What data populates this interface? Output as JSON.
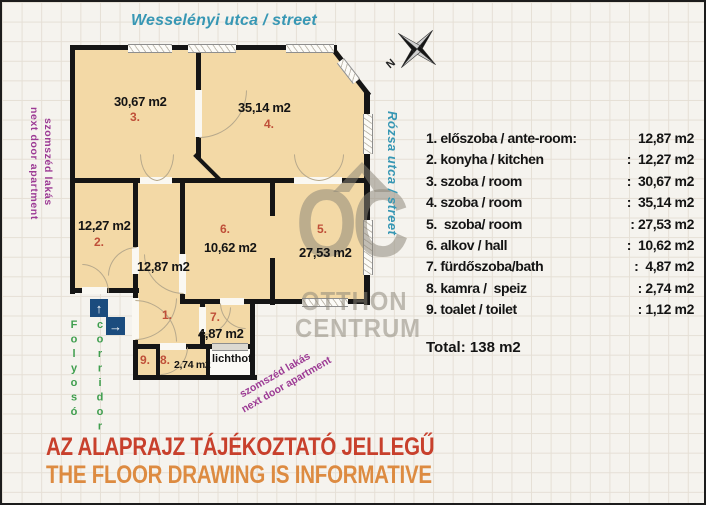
{
  "header": {
    "street_top": "Wesselényi utca / street"
  },
  "side_labels": {
    "street_right": "Rózsa utca / street",
    "neighbor_left_hu": "szomszéd lakás",
    "neighbor_left_en": "next door apartment",
    "neighbor_bottom_hu": "szomszéd lakás",
    "neighbor_bottom_en": "next door apartment",
    "corridor_hu": "Folyosó",
    "corridor_en": "corridor",
    "lichthof": "lichthof"
  },
  "compass": {
    "north_label": "N"
  },
  "watermark": {
    "monogram": "OC",
    "name_line1": "OTTHON",
    "name_line2": "CENTRUM"
  },
  "plan_rooms": {
    "r1": {
      "num": "1.",
      "area": "12,87 m2"
    },
    "r2": {
      "num": "2.",
      "area": "12,27 m2"
    },
    "r3": {
      "num": "3.",
      "area": "30,67 m2"
    },
    "r4": {
      "num": "4.",
      "area": "35,14 m2"
    },
    "r5": {
      "num": "5.",
      "area": "27,53 m2"
    },
    "r6": {
      "num": "6.",
      "area": "10,62 m2"
    },
    "r7": {
      "num": "7.",
      "area": "4,87 m2"
    },
    "r8": {
      "num": "8.",
      "area": "2,74 m2"
    },
    "r9": {
      "num": "9."
    }
  },
  "legend": {
    "rows": [
      {
        "label": "1. előszoba / ante-room:",
        "value": "12,87 m2"
      },
      {
        "label": "2. konyha / kitchen",
        "value": ":  12,27 m2"
      },
      {
        "label": "3. szoba / room",
        "value": ":  30,67 m2"
      },
      {
        "label": "4. szoba / room",
        "value": ":  35,14 m2"
      },
      {
        "label": "5.  szoba/ room",
        "value": ": 27,53 m2"
      },
      {
        "label": "6. alkov / hall",
        "value": ":  10,62 m2"
      },
      {
        "label": "7. fürdőszoba/bath",
        "value": ":  4,87 m2"
      },
      {
        "label": "8. kamra /  speiz",
        "value": ": 2,74 m2"
      },
      {
        "label": "9. toalet / toilet",
        "value": ": 1,12 m2"
      }
    ],
    "total": "Total: 138 m2"
  },
  "disclaimer": {
    "hu": "AZ ALAPRAJZ TÁJÉKOZTATÓ JELLEGŰ",
    "en": "THE FLOOR DRAWING IS INFORMATIVE"
  },
  "colors": {
    "wall": "#151515",
    "room_fill": "#f3d9a6",
    "street_text": "#3797b4",
    "neighbor_text": "#9c3a94",
    "corridor_text": "#3f9e4e",
    "room_number": "#bf4f38",
    "disclaimer_hu": "#c8402c",
    "disclaimer_en": "#dd8b41",
    "entry_arrow_bg": "#1b4c7e",
    "watermark": "#8a8476"
  }
}
